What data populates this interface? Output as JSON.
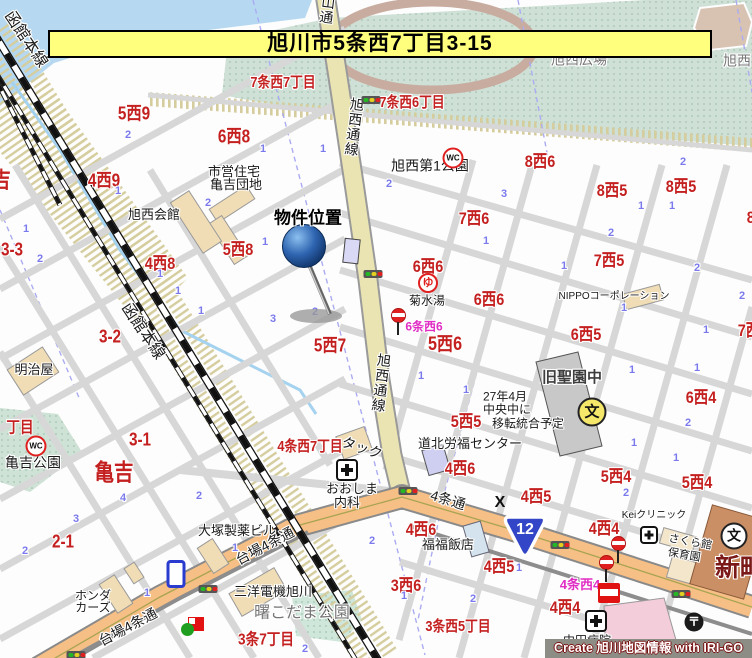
{
  "banner": {
    "text": "旭川市5条西7丁目3-15"
  },
  "credit": {
    "text": "Create 旭川地図情報 with IRI-GO"
  },
  "marker": {
    "label": "物件位置"
  },
  "route_shield": {
    "number": "12"
  },
  "colors": {
    "banner_bg": "#ffff7d",
    "road_orange": "#f6bf85",
    "road_avenue": "#eae4b2",
    "park_green": "#cfe0d6",
    "water_blue": "#b6d9f1",
    "label_red": "#c42020",
    "label_magenta": "#e02ec4",
    "block_number_blue": "#7a7aec"
  },
  "labels": {
    "red_areas": [
      {
        "t": "7条西7丁目",
        "x": 283,
        "y": 83,
        "fs": 15
      },
      {
        "t": "7条西6丁目",
        "x": 412,
        "y": 103,
        "fs": 15
      },
      {
        "t": "5西9",
        "x": 134,
        "y": 114,
        "fs": 18
      },
      {
        "t": "6西8",
        "x": 234,
        "y": 137,
        "fs": 18
      },
      {
        "t": "8西6",
        "x": 540,
        "y": 162,
        "fs": 17
      },
      {
        "t": "4西9",
        "x": 104,
        "y": 181,
        "fs": 18
      },
      {
        "t": "8西5",
        "x": 612,
        "y": 191,
        "fs": 17
      },
      {
        "t": "8西5",
        "x": 681,
        "y": 187,
        "fs": 17
      },
      {
        "t": "亀吉",
        "x": -8,
        "y": 180,
        "fs": 22
      },
      {
        "t": "7西6",
        "x": 474,
        "y": 219,
        "fs": 17
      },
      {
        "t": "8西4",
        "x": 762,
        "y": 218,
        "fs": 17
      },
      {
        "t": "5西8",
        "x": 238,
        "y": 250,
        "fs": 17
      },
      {
        "t": "3-3",
        "x": 12,
        "y": 250,
        "fs": 18
      },
      {
        "t": "4西8",
        "x": 160,
        "y": 264,
        "fs": 17
      },
      {
        "t": "7西5",
        "x": 609,
        "y": 261,
        "fs": 17
      },
      {
        "t": "6西6",
        "x": 428,
        "y": 267,
        "fs": 17
      },
      {
        "t": "6西6",
        "x": 489,
        "y": 300,
        "fs": 17
      },
      {
        "t": "7西4",
        "x": 753,
        "y": 331,
        "fs": 17
      },
      {
        "t": "5西7",
        "x": 330,
        "y": 346,
        "fs": 18
      },
      {
        "t": "5西6",
        "x": 445,
        "y": 345,
        "fs": 19
      },
      {
        "t": "6西5",
        "x": 586,
        "y": 335,
        "fs": 17
      },
      {
        "t": "3-2",
        "x": 110,
        "y": 337,
        "fs": 18
      },
      {
        "t": "6西4",
        "x": 701,
        "y": 398,
        "fs": 17
      },
      {
        "t": "5西5",
        "x": 466,
        "y": 422,
        "fs": 17
      },
      {
        "t": "丁目",
        "x": 20,
        "y": 429,
        "fs": 16
      },
      {
        "t": "3-1",
        "x": 140,
        "y": 440,
        "fs": 18
      },
      {
        "t": "4条西7丁目",
        "x": 310,
        "y": 447,
        "fs": 15
      },
      {
        "t": "亀吉",
        "x": 114,
        "y": 472,
        "fs": 23
      },
      {
        "t": "4西6",
        "x": 460,
        "y": 469,
        "fs": 17
      },
      {
        "t": "5西4",
        "x": 616,
        "y": 477,
        "fs": 17
      },
      {
        "t": "5西4",
        "x": 697,
        "y": 483,
        "fs": 17
      },
      {
        "t": "4西5",
        "x": 536,
        "y": 497,
        "fs": 17
      },
      {
        "t": "4西4",
        "x": 604,
        "y": 529,
        "fs": 17
      },
      {
        "t": "4西6",
        "x": 421,
        "y": 530,
        "fs": 17
      },
      {
        "t": "2-1",
        "x": 63,
        "y": 542,
        "fs": 18
      },
      {
        "t": "4西5",
        "x": 499,
        "y": 567,
        "fs": 17
      },
      {
        "t": "3西6",
        "x": 406,
        "y": 586,
        "fs": 17
      },
      {
        "t": "4西4",
        "x": 565,
        "y": 608,
        "fs": 17
      },
      {
        "t": "3条7丁目",
        "x": 266,
        "y": 641,
        "fs": 16
      },
      {
        "t": "3条西5丁目",
        "x": 458,
        "y": 627,
        "fs": 15
      }
    ],
    "black_places": [
      {
        "t": "市営住宅",
        "x": 234,
        "y": 172,
        "fs": 13
      },
      {
        "t": "亀吉団地",
        "x": 236,
        "y": 185,
        "fs": 13
      },
      {
        "t": "旭西会館",
        "x": 154,
        "y": 215,
        "fs": 13
      },
      {
        "t": "旭西第1公園",
        "x": 430,
        "y": 166,
        "fs": 14
      },
      {
        "t": "菊水湯",
        "x": 427,
        "y": 301,
        "fs": 12
      },
      {
        "t": "NIPPOコーポレーション",
        "x": 614,
        "y": 297,
        "fs": 10
      },
      {
        "t": "明治屋",
        "x": 34,
        "y": 370,
        "fs": 13
      },
      {
        "t": "亀吉公園",
        "x": 33,
        "y": 463,
        "fs": 14
      },
      {
        "t": "旧聖園中",
        "x": 572,
        "y": 378,
        "fs": 15,
        "b": 1,
        "c": "#3d3d3d"
      },
      {
        "t": "27年4月",
        "x": 505,
        "y": 397,
        "fs": 12
      },
      {
        "t": "中央中に",
        "x": 507,
        "y": 410,
        "fs": 12
      },
      {
        "t": "移転統合予定",
        "x": 528,
        "y": 424,
        "fs": 12
      },
      {
        "t": "道北労福センター",
        "x": 470,
        "y": 444,
        "fs": 13
      },
      {
        "t": "タック",
        "x": 362,
        "y": 448,
        "fs": 14,
        "rot": 18
      },
      {
        "t": "おおしま",
        "x": 352,
        "y": 489,
        "fs": 13
      },
      {
        "t": "内科",
        "x": 347,
        "y": 503,
        "fs": 13
      },
      {
        "t": "大塚製薬ビル",
        "x": 237,
        "y": 531,
        "fs": 13
      },
      {
        "t": "福福飯店",
        "x": 448,
        "y": 545,
        "fs": 13
      },
      {
        "t": "Keiクリニック",
        "x": 654,
        "y": 516,
        "fs": 10
      },
      {
        "t": "さくら館",
        "x": 690,
        "y": 543,
        "fs": 11,
        "rot": 10
      },
      {
        "t": "保育園",
        "x": 684,
        "y": 556,
        "fs": 11,
        "rot": 10
      },
      {
        "t": "ホンダ",
        "x": 93,
        "y": 596,
        "fs": 12
      },
      {
        "t": "カーズ",
        "x": 93,
        "y": 608,
        "fs": 12
      },
      {
        "t": "三洋電機旭川",
        "x": 273,
        "y": 592,
        "fs": 13
      },
      {
        "t": "中田病院",
        "x": 587,
        "y": 641,
        "fs": 12
      },
      {
        "t": "新町",
        "x": 740,
        "y": 568,
        "fs": 25,
        "b": 1,
        "c": "#7b1818"
      }
    ],
    "gray_places": [
      {
        "t": "旭西広場",
        "x": 579,
        "y": 60,
        "fs": 14
      },
      {
        "t": "旭西",
        "x": 737,
        "y": 61,
        "fs": 14
      },
      {
        "t": "曙こだま公園",
        "x": 302,
        "y": 614,
        "fs": 16
      }
    ],
    "magenta_busstops": [
      {
        "t": "6条西6",
        "x": 424,
        "y": 327,
        "fs": 12
      },
      {
        "t": "4条西4",
        "x": 580,
        "y": 585,
        "fs": 13
      }
    ],
    "road_names": [
      {
        "t": "台場4条通",
        "x": 265,
        "y": 546,
        "fs": 14,
        "rot": -28
      },
      {
        "t": "台場4条通",
        "x": 128,
        "y": 627,
        "fs": 14,
        "rot": -28
      },
      {
        "t": "4条通",
        "x": 448,
        "y": 500,
        "fs": 14,
        "rot": 17
      },
      {
        "t": "旭西通線",
        "x": 354,
        "y": 127,
        "fs": 14,
        "vert": 1,
        "rot": 7
      },
      {
        "t": "旭西通線",
        "x": 381,
        "y": 383,
        "fs": 14,
        "vert": 1,
        "rot": 7
      },
      {
        "t": "山通",
        "x": 327,
        "y": 10,
        "fs": 14,
        "vert": 1,
        "rot": 7
      },
      {
        "t": "函館本線",
        "x": 25,
        "y": 40,
        "fs": 16,
        "rot": 56
      },
      {
        "t": "函館本線",
        "x": 142,
        "y": 332,
        "fs": 16,
        "rot": 56
      }
    ],
    "blue_numbers": [
      [
        128,
        136,
        "2"
      ],
      [
        263,
        150,
        "1"
      ],
      [
        323,
        150,
        "1"
      ],
      [
        389,
        185,
        "2"
      ],
      [
        504,
        195,
        "3"
      ],
      [
        641,
        207,
        "1"
      ],
      [
        672,
        207,
        "1"
      ],
      [
        611,
        234,
        "2"
      ],
      [
        486,
        242,
        "1"
      ],
      [
        564,
        267,
        "1"
      ],
      [
        697,
        269,
        "2"
      ],
      [
        742,
        297,
        "2"
      ],
      [
        624,
        309,
        "1"
      ],
      [
        118,
        192,
        "1"
      ],
      [
        208,
        204,
        "2"
      ],
      [
        26,
        230,
        "1"
      ],
      [
        40,
        260,
        "2"
      ],
      [
        160,
        275,
        "1"
      ],
      [
        178,
        292,
        "1"
      ],
      [
        201,
        312,
        "1"
      ],
      [
        273,
        320,
        "3"
      ],
      [
        315,
        313,
        "2"
      ],
      [
        265,
        243,
        "1"
      ],
      [
        683,
        163,
        "2"
      ],
      [
        706,
        331,
        "1"
      ],
      [
        421,
        377,
        "1"
      ],
      [
        466,
        391,
        "1"
      ],
      [
        632,
        371,
        "1"
      ],
      [
        697,
        369,
        "1"
      ],
      [
        688,
        424,
        "2"
      ],
      [
        634,
        444,
        "1"
      ],
      [
        676,
        459,
        "1"
      ],
      [
        123,
        499,
        "4"
      ],
      [
        199,
        497,
        "2"
      ],
      [
        76,
        520,
        "3"
      ],
      [
        25,
        552,
        "2"
      ],
      [
        235,
        549,
        "1"
      ],
      [
        372,
        542,
        "2"
      ],
      [
        147,
        594,
        "1"
      ],
      [
        626,
        494,
        "2"
      ],
      [
        519,
        569,
        "1"
      ],
      [
        404,
        597,
        "1"
      ],
      [
        473,
        600,
        "2"
      ],
      [
        305,
        650,
        "2"
      ]
    ]
  },
  "icons": [
    {
      "name": "wc-icon",
      "x": 36,
      "y": 446,
      "g": "WC"
    },
    {
      "name": "wc-icon",
      "x": 453,
      "y": 158,
      "g": "WC"
    },
    {
      "name": "bath-icon",
      "x": 428,
      "y": 283,
      "g": "ゆ"
    },
    {
      "name": "school-icon-yellow",
      "x": 592,
      "y": 412,
      "g": "文"
    },
    {
      "name": "school-icon",
      "x": 734,
      "y": 536,
      "g": "文"
    },
    {
      "name": "post-office-icon",
      "x": 694,
      "y": 622,
      "g": "〒"
    },
    {
      "name": "police-x-icon",
      "x": 500,
      "y": 503,
      "g": "X"
    },
    {
      "name": "hospital-icon",
      "x": 347,
      "y": 470
    },
    {
      "name": "hospital-icon-small",
      "x": 649,
      "y": 535
    },
    {
      "name": "hospital-icon-dark",
      "x": 596,
      "y": 621
    },
    {
      "name": "bus-stop-icon",
      "x": 398,
      "y": 322
    },
    {
      "name": "bus-stop-icon",
      "x": 618,
      "y": 550
    },
    {
      "name": "bus-stop-icon",
      "x": 606,
      "y": 569
    },
    {
      "name": "traffic-light-icon",
      "x": 373,
      "y": 274
    },
    {
      "name": "traffic-light-icon",
      "x": 371,
      "y": 100
    },
    {
      "name": "traffic-light-icon",
      "x": 408,
      "y": 491
    },
    {
      "name": "traffic-light-icon",
      "x": 560,
      "y": 545
    },
    {
      "name": "traffic-light-icon",
      "x": 681,
      "y": 594
    },
    {
      "name": "traffic-light-icon",
      "x": 208,
      "y": 589
    },
    {
      "name": "traffic-light-icon",
      "x": 76,
      "y": 655
    },
    {
      "name": "gas-station-icon",
      "x": 609,
      "y": 593
    },
    {
      "name": "store-icon",
      "x": 196,
      "y": 624
    },
    {
      "name": "shield-icon-blue",
      "x": 176,
      "y": 574
    }
  ]
}
